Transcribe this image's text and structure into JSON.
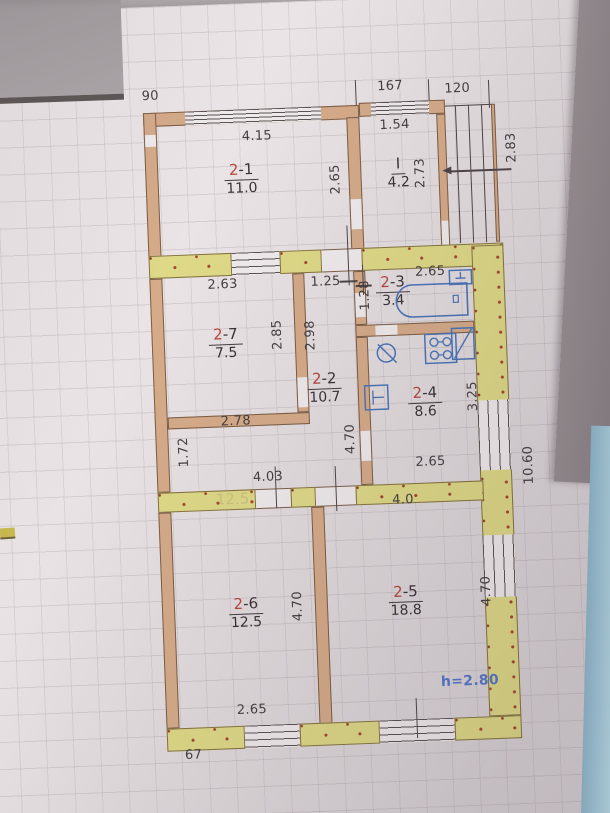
{
  "plan": {
    "top_dims": {
      "left": "90",
      "middle": "167",
      "right": "120"
    },
    "rooms": {
      "r21": {
        "no": "2",
        "suf": "-1",
        "area": "11.0"
      },
      "hall": {
        "no": "I",
        "suf": "",
        "area": "4.2"
      },
      "r23": {
        "no": "2",
        "suf": "-3",
        "area": "3.4"
      },
      "r27": {
        "no": "2",
        "suf": "-7",
        "area": "7.5"
      },
      "r22": {
        "no": "2",
        "suf": "-2",
        "area": "10.7"
      },
      "r24": {
        "no": "2",
        "suf": "-4",
        "area": "8.6"
      },
      "r26": {
        "no": "2",
        "suf": "-6",
        "area": "12.5"
      },
      "r25": {
        "no": "2",
        "suf": "-5",
        "area": "18.8"
      }
    },
    "dims": {
      "w21": "4.15",
      "w_hall": "1.54",
      "h21": "2.65",
      "h_hall": "2.73",
      "porch_depth": "2.83",
      "w27": "2.63",
      "corridor_top": "1.25",
      "w_bath": "2.65",
      "h_bath": "1.28",
      "door27a": "2.85",
      "door27b": "2.98",
      "w27_bottom": "2.78",
      "hall_lower": "1.72",
      "corridor_len": "4.70",
      "kitchen_h": "3.25",
      "kitchen_w": "2.65",
      "lobby_w": "4.03",
      "w25_top": "4.0",
      "h26": "4.70",
      "h25": "4.70",
      "w26_bottom": "2.65",
      "total_right": "10.60",
      "bottom_left": "67"
    },
    "notes": {
      "ceiling_height": "h=2.80",
      "bleed_through": "12.5"
    },
    "fixtures": {
      "bathtub": "bathtub",
      "washbasin": "washbasin",
      "kitchen_sink": "kitchen-sink",
      "round_sink": "round-sink",
      "stove": "stove",
      "fridge": "fridge"
    },
    "colors": {
      "wall_tan": "#d5ab89",
      "wall_yellow": "#ded987",
      "wall_dot_red": "#a8422c",
      "drawing_line": "#4e4548",
      "fixture_blue": "#4a74b8",
      "room_number_red": "#b5473c",
      "note_blue": "#5577c9",
      "paper": "#e9e3e5",
      "background": "#b1abad",
      "side_strip_blue": "#a6d0e2"
    }
  }
}
